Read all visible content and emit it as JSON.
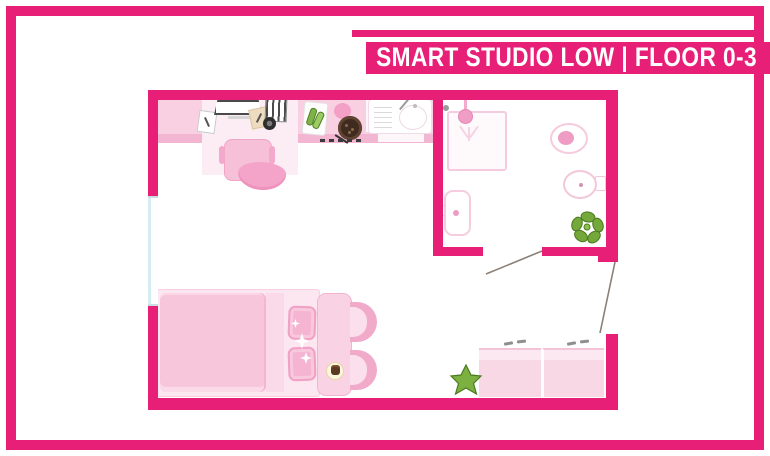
{
  "banner": {
    "title": "SMART STUDIO LOW | FLOOR 0-3"
  },
  "plan": {
    "rooms": [
      {
        "name": "studio-main-room"
      },
      {
        "name": "bathroom"
      }
    ],
    "furniture_icons": [
      "kitchen-counter",
      "kitchen-sink",
      "stove-with-pan",
      "cutting-board",
      "pink-plate",
      "paper-note",
      "notepad",
      "file-organizer",
      "bowl",
      "monitor",
      "desk",
      "office-chair",
      "window",
      "shower",
      "shower-head",
      "toilet",
      "round-washbasin",
      "towel-radiator",
      "potted-plant-clover",
      "bed",
      "blanket",
      "pillow",
      "pillow",
      "sparkle-stars",
      "side-table",
      "half-round-chair",
      "half-round-chair",
      "plate-with-cupcake",
      "wardrobe-unit",
      "wardrobe-unit",
      "floor-plant-star",
      "bathroom-door",
      "entrance-door"
    ]
  },
  "colors": {
    "accent_magenta": "#E81F76",
    "counter_pink": "#F8D0E2",
    "furniture_pink": "#F8C6DB",
    "fixture_outline_pink": "#F5CCDF",
    "plant_green": "#74A83B",
    "background": "#FFFFFF"
  }
}
